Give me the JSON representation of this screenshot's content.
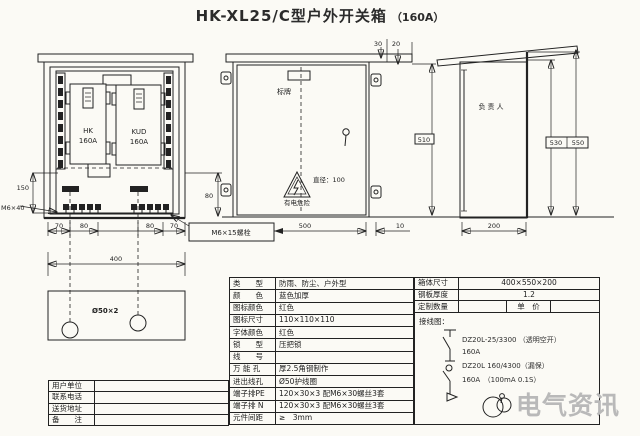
{
  "colors": {
    "line": "#222222",
    "background": "#fbfaf5",
    "red_accent": "#cc2020",
    "watermark_gray": "#b9b9b9"
  },
  "title": {
    "model": "HK-XL25/C型户外开关箱",
    "rating": "（160A）"
  },
  "front_view": {
    "breaker_left_name": "HK",
    "breaker_left_rating": "160A",
    "breaker_right_name": "KUD",
    "breaker_right_rating": "160A",
    "dim_left_height": "150",
    "bolt_label_left": "M6×40",
    "dim_bottom_1": "70",
    "dim_bottom_2": "80",
    "dim_bottom_3": "80",
    "dim_bottom_4": "70",
    "dim_total_width": "400",
    "dim_right_height": "80",
    "bolt_note": "M6×15螺栓",
    "plate_holes_label": "Ø50×2"
  },
  "door_view": {
    "nameplate_label": "标牌",
    "diameter_note": "直径：100",
    "warning_text": "有电危险",
    "dim_top_1": "30",
    "dim_top_2": "20",
    "dim_width": "500",
    "dim_gap": "10",
    "dim_height": "510"
  },
  "side_view": {
    "door_label": "负责人",
    "dim_height_inner": "530",
    "dim_height_outer": "550",
    "dim_depth": "200"
  },
  "contact_table": {
    "rows": [
      {
        "label": "用户单位",
        "value": ""
      },
      {
        "label": "联系电话",
        "value": ""
      },
      {
        "label": "送货地址",
        "value": ""
      },
      {
        "label": "备　　注",
        "value": ""
      }
    ]
  },
  "spec_table": {
    "rows": [
      {
        "label": "类　　型",
        "value": "防雨、防尘、户外型"
      },
      {
        "label": "颜　　色",
        "value": "蓝色加厚"
      },
      {
        "label": "图标颜色",
        "value": "红色"
      },
      {
        "label": "图标尺寸",
        "value": "110×110×110"
      },
      {
        "label": "字体颜色",
        "value": "红色"
      },
      {
        "label": "锁　　型",
        "value": "压把锁"
      },
      {
        "label": "线　　号",
        "value": ""
      },
      {
        "label": "万 能 孔",
        "value": "厚2.5角钢制作"
      },
      {
        "label": "进出线孔",
        "value": "Ø50护线圈"
      },
      {
        "label": "端子排PE",
        "value": "120×30×3 配M6×30螺丝3套"
      },
      {
        "label": "端子排 N",
        "value": "120×30×3 配M6×30螺丝3套"
      },
      {
        "label": "元件间距",
        "value": "≥　3mm"
      }
    ]
  },
  "order_table": {
    "box_size_label": "箱体尺寸",
    "box_size_value": "400×550×200",
    "steel_label": "钢板厚度",
    "steel_value": "1.2",
    "qty_label": "定制数量",
    "qty_value": "",
    "price_label": "单　价",
    "price_value": "",
    "wiring_label": "接线图："
  },
  "wiring": {
    "breaker1_model": "DZ20L-25/3300 （透明空开）",
    "breaker1_rating": "160A",
    "breaker2_model": "DZ20L 160/4300（漏保）",
    "breaker2_rating": "160A　（100mA  0.1S）"
  },
  "watermark": {
    "brand": "电气资讯"
  }
}
